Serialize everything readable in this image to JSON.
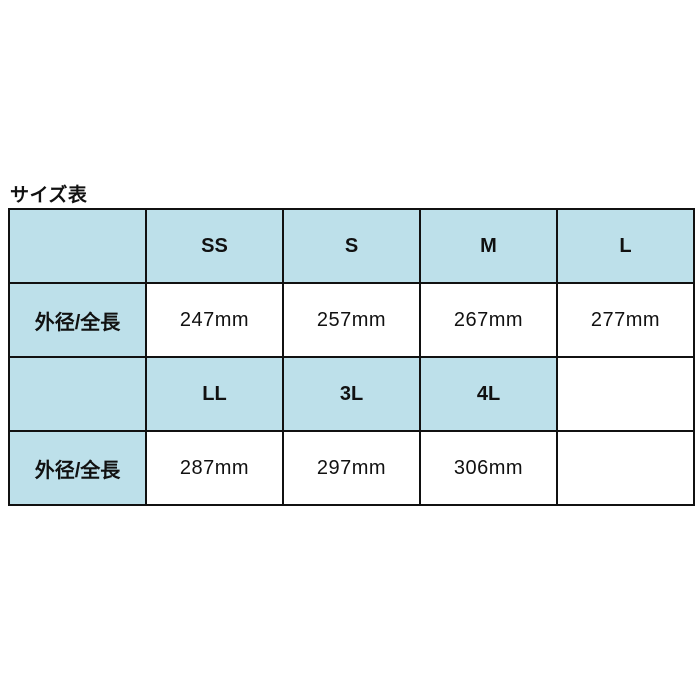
{
  "page": {
    "title": "サイズ表"
  },
  "table": {
    "sections": [
      {
        "row_label": "外径/全長",
        "columns": [
          "SS",
          "S",
          "M",
          "L"
        ],
        "values": [
          "247mm",
          "257mm",
          "267mm",
          "277mm"
        ]
      },
      {
        "row_label": "外径/全長",
        "columns": [
          "LL",
          "3L",
          "4L"
        ],
        "values": [
          "287mm",
          "297mm",
          "306mm"
        ]
      }
    ]
  },
  "colors": {
    "header_bg": "#bde0ea",
    "cell_bg": "#ffffff",
    "border": "#111111",
    "text": "#111111"
  },
  "chart_data": {
    "type": "table",
    "title": "サイズ表",
    "row_label": "外径/全長",
    "columns": [
      "SS",
      "S",
      "M",
      "L",
      "LL",
      "3L",
      "4L"
    ],
    "values": [
      "247mm",
      "257mm",
      "267mm",
      "277mm",
      "287mm",
      "297mm",
      "306mm"
    ]
  }
}
